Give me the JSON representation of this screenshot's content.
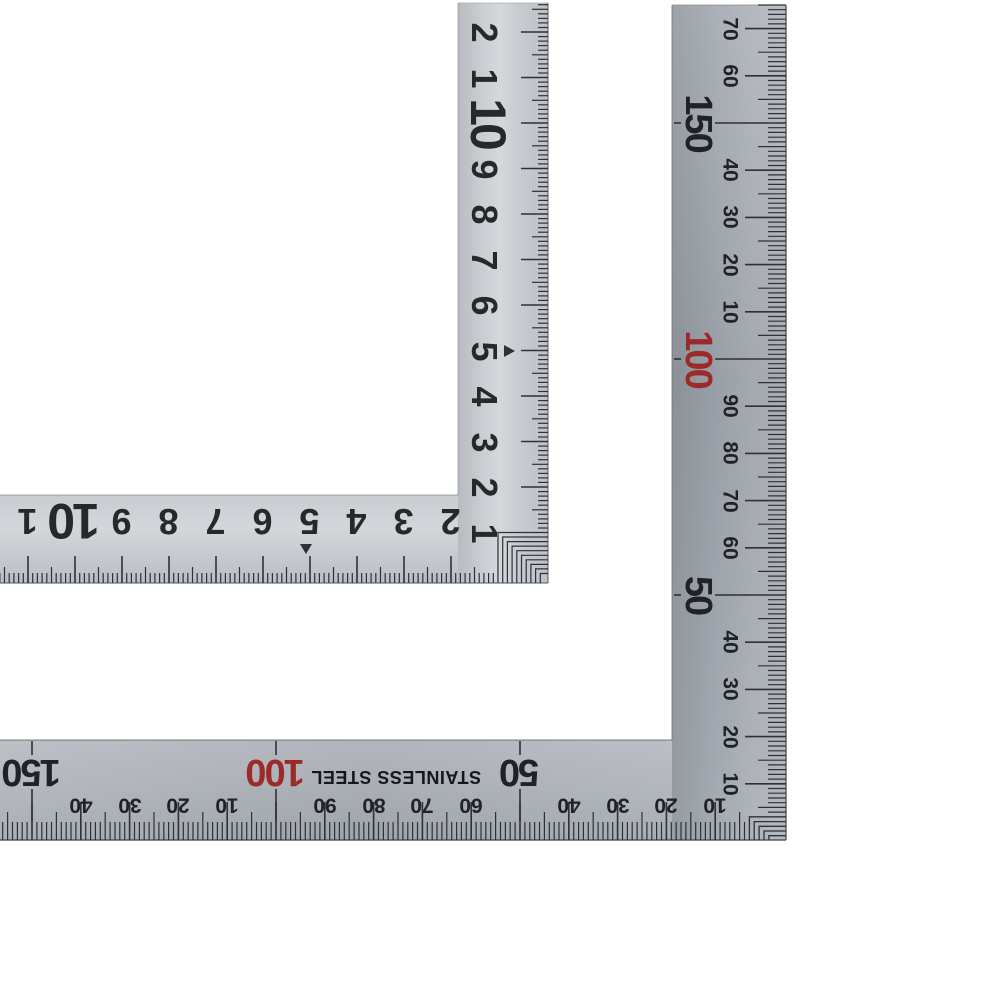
{
  "photo": {
    "subject": "L-shaped stainless steel square ruler, two views on white background",
    "background": "#ffffff"
  },
  "colors": {
    "red_accent": "#9b2a28",
    "ink": "#26282c",
    "tick": "#2e3136",
    "steel_light": "#cbcfd3",
    "steel_dark": "#9aa0aa"
  },
  "ruler_cm": {
    "view": "centimeter scale (upper-left ruler)",
    "vertical_arm_labels": [
      {
        "u": 1,
        "t": "1"
      },
      {
        "u": 2,
        "t": "2"
      },
      {
        "u": 3,
        "t": "3"
      },
      {
        "u": 4,
        "t": "4"
      },
      {
        "u": 5,
        "t": "5"
      },
      {
        "u": 6,
        "t": "6"
      },
      {
        "u": 7,
        "t": "7"
      },
      {
        "u": 8,
        "t": "8"
      },
      {
        "u": 9,
        "t": "9"
      },
      {
        "u": 10,
        "t": "10",
        "big": true
      },
      {
        "u": 11,
        "t": "1"
      },
      {
        "u": 12,
        "t": "2"
      }
    ],
    "horizontal_arm_labels": [
      {
        "u": 2,
        "t": "2"
      },
      {
        "u": 3,
        "t": "3"
      },
      {
        "u": 4,
        "t": "4"
      },
      {
        "u": 5,
        "t": "5"
      },
      {
        "u": 6,
        "t": "6"
      },
      {
        "u": 7,
        "t": "7"
      },
      {
        "u": 8,
        "t": "8"
      },
      {
        "u": 9,
        "t": "9"
      },
      {
        "u": 10,
        "t": "10",
        "big": true
      },
      {
        "u": 11,
        "t": "1"
      }
    ],
    "center_marker_u": 5
  },
  "ruler_mm": {
    "view": "millimeter scale (lower-right ruler)",
    "brand_text": "STAINLESS STEEL",
    "vertical_arm_labels": [
      {
        "u": 10,
        "t": "10"
      },
      {
        "u": 20,
        "t": "20"
      },
      {
        "u": 30,
        "t": "30"
      },
      {
        "u": 40,
        "t": "40"
      },
      {
        "u": 50,
        "t": "50",
        "big": true
      },
      {
        "u": 60,
        "t": "60"
      },
      {
        "u": 70,
        "t": "70"
      },
      {
        "u": 80,
        "t": "80"
      },
      {
        "u": 90,
        "t": "90"
      },
      {
        "u": 100,
        "t": "100",
        "big": true,
        "red": true
      },
      {
        "u": 110,
        "t": "10"
      },
      {
        "u": 120,
        "t": "20"
      },
      {
        "u": 130,
        "t": "30"
      },
      {
        "u": 140,
        "t": "40"
      },
      {
        "u": 150,
        "t": "150",
        "big": true
      },
      {
        "u": 160,
        "t": "60"
      },
      {
        "u": 170,
        "t": "70"
      }
    ],
    "horizontal_arm_labels": [
      {
        "u": 10,
        "t": "10"
      },
      {
        "u": 20,
        "t": "20"
      },
      {
        "u": 30,
        "t": "30"
      },
      {
        "u": 40,
        "t": "40"
      },
      {
        "u": 50,
        "t": "50",
        "big": true
      },
      {
        "u": 60,
        "t": "60"
      },
      {
        "u": 70,
        "t": "70"
      },
      {
        "u": 80,
        "t": "80"
      },
      {
        "u": 90,
        "t": "90"
      },
      {
        "u": 100,
        "t": "100",
        "big": true,
        "red": true
      },
      {
        "u": 110,
        "t": "10"
      },
      {
        "u": 120,
        "t": "20"
      },
      {
        "u": 130,
        "t": "30"
      },
      {
        "u": 140,
        "t": "40"
      },
      {
        "u": 150,
        "t": "150",
        "big": true
      }
    ]
  }
}
